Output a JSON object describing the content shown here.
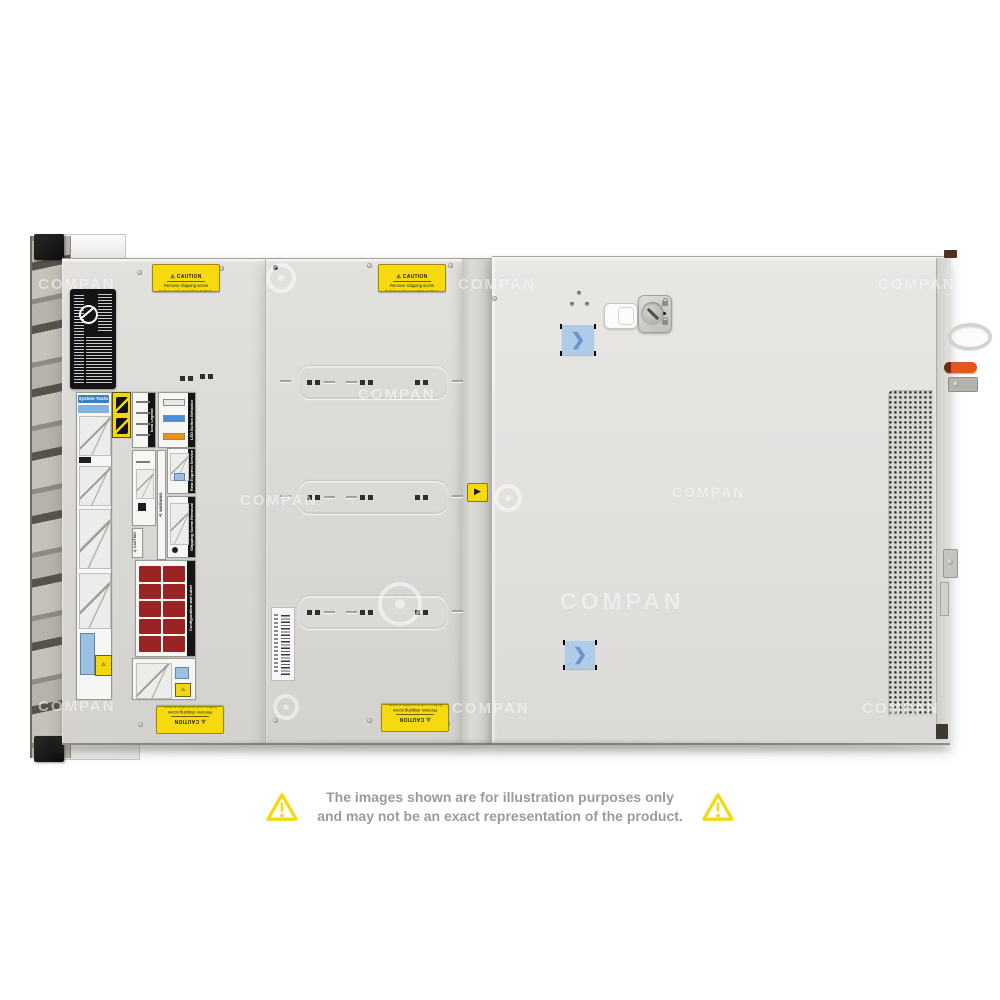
{
  "watermark": {
    "text": "COMPAN"
  },
  "stickers": {
    "caution": {
      "title": "⚠ CAUTION",
      "line1": "Remove shipping screw",
      "line2": "before rack mounting system"
    },
    "divider_triangle": "▶"
  },
  "labels": {
    "system_tasks": "System Tasks",
    "icon_legend": "Icon Legend",
    "led_behavior": "LED Button Behavior",
    "rear_tag": "Rear Express Service Tag",
    "shipping_screw": "Shipping Screw Removal",
    "warning": "⚠ WARNING",
    "caution_small": "⚠ CAUTION",
    "config": "Configuration and Label"
  },
  "blue_sticker_chevron": "❯",
  "disclaimer": {
    "line1": "The images shown are for illustration purposes only",
    "line2": "and may not be an exact representation of the product."
  },
  "colors": {
    "chassis": "#DCDBD8",
    "caution_yellow": "#F6D90E",
    "triangle_yellow": "#F5D90F",
    "disclaimer_gray": "#9B9B9B",
    "blue_sticker": "#AECBE9",
    "chevron_blue": "#6E93CC",
    "orange_lever": "#E2571C",
    "red_blocks": "#9A2424"
  }
}
